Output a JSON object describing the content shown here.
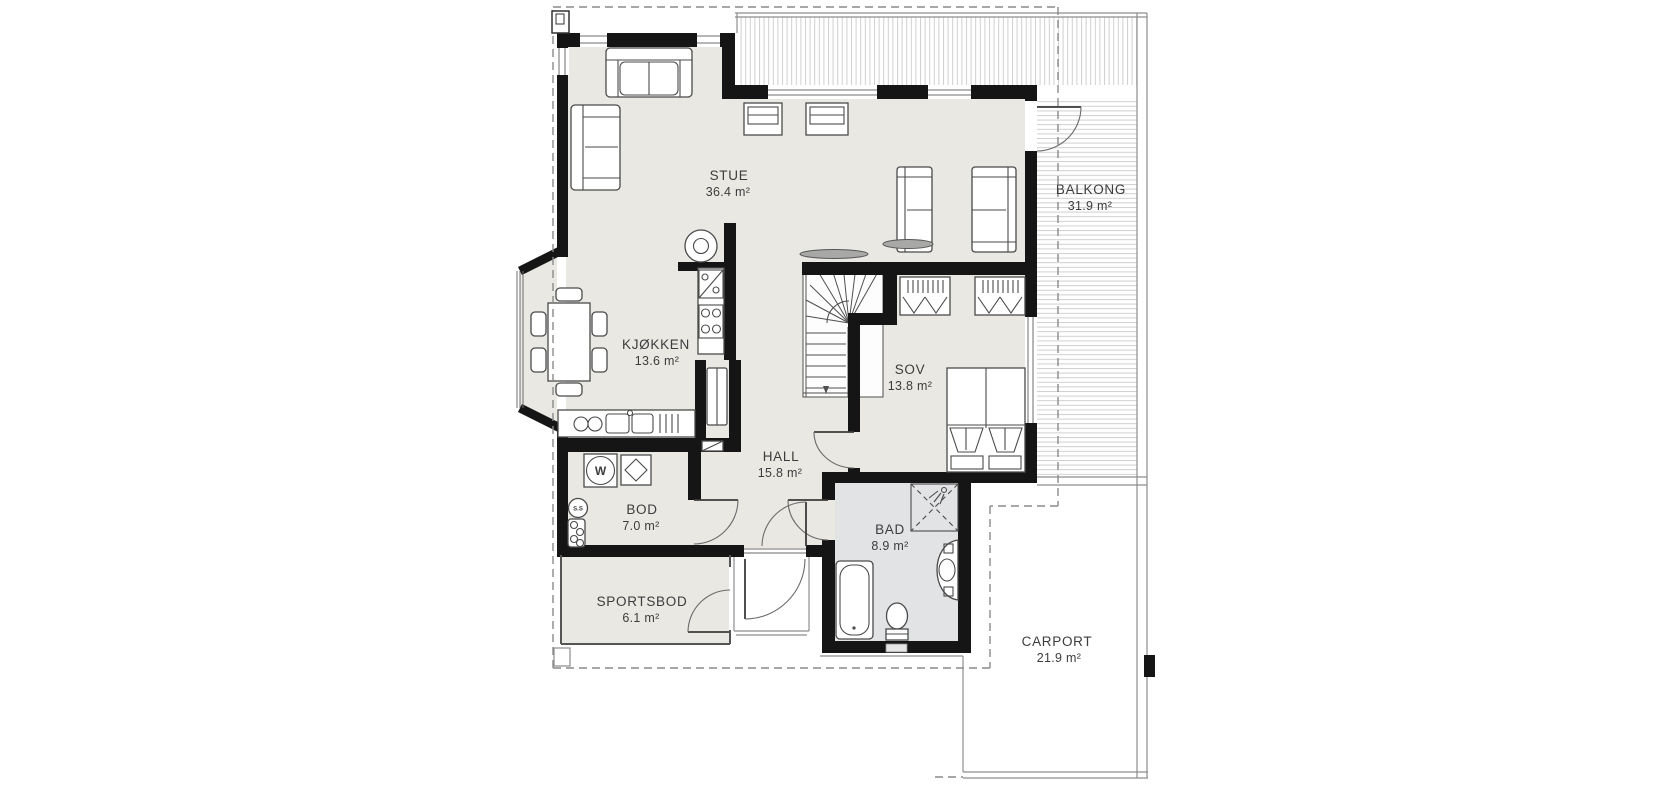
{
  "plan": {
    "type": "floor-plan",
    "language": "Norwegian",
    "rooms": {
      "stue": {
        "name": "STUE",
        "area": "36.4 m²"
      },
      "kjokken": {
        "name": "KJØKKEN",
        "area": "13.6 m²"
      },
      "sov": {
        "name": "SOV",
        "area": "13.8 m²"
      },
      "hall": {
        "name": "HALL",
        "area": "15.8 m²"
      },
      "bod": {
        "name": "BOD",
        "area": "7.0 m²"
      },
      "bad": {
        "name": "BAD",
        "area": "8.9 m²"
      },
      "sportsbod": {
        "name": "SPORTSBOD",
        "area": "6.1 m²"
      },
      "balkong": {
        "name": "BALKONG",
        "area": "31.9 m²"
      },
      "carport": {
        "name": "CARPORT",
        "area": "21.9 m²"
      }
    },
    "fixture_labels": {
      "washing_machine": "W",
      "water_heater": "S.S"
    },
    "symbols": [
      "sofa",
      "loveseat",
      "dining-table",
      "chair",
      "kitchen-counter",
      "double-sink",
      "stove",
      "dishwasher",
      "fireplace",
      "winder-stairs",
      "wardrobe",
      "double-bed",
      "bathtub",
      "corner-shower",
      "toilet",
      "vanity-sink",
      "washing-machine",
      "water-heater",
      "door-swing",
      "window",
      "casement-window",
      "deck-boards",
      "roof-overhang-dashed",
      "carport-outline",
      "chimney"
    ],
    "colors": {
      "background": "#ffffff",
      "floor": "#e9e8e3",
      "bathroom_floor": "#e2e3e5",
      "wall": "#151515",
      "furniture_line": "#4a4a4a",
      "deck_line": "#cfcfcf",
      "dashed_line": "#8a8a8a",
      "text": "#3c3c3c"
    }
  }
}
